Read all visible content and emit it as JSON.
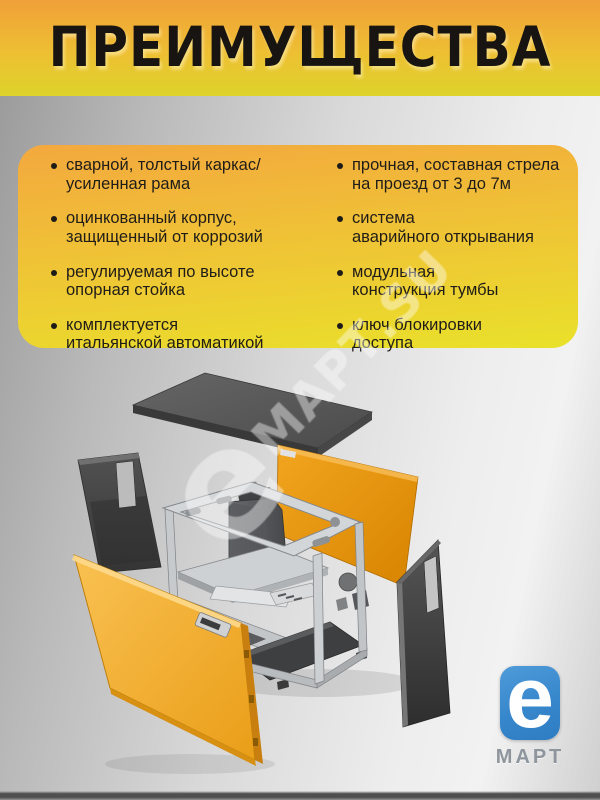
{
  "header": {
    "title": "ПРЕИМУЩЕСТВА"
  },
  "card": {
    "left": [
      "сварной, толстый каркас/\nусиленная рама",
      "оцинкованный корпус,\nзащищенный от коррозий",
      "регулируемая по высоте\nопорная стойка",
      "комплектуется\nитальянской автоматикой"
    ],
    "right": [
      "прочная, составная стрела\nна проезд от 3 до 7м",
      "система\nаварийного открывания",
      "модульная\nконструкция тумбы",
      "ключ блокировки\nдоступа"
    ]
  },
  "watermark": {
    "e": "e",
    "text": "МАРТ.SU"
  },
  "logo": {
    "letter": "e",
    "brand": "МАРТ"
  },
  "diagram": {
    "type": "exploded-view",
    "parts": [
      "top-cover",
      "left-rear-panel",
      "rear-orange-panel",
      "cabinet-frame",
      "motor-unit",
      "base-plate",
      "right-side-panel",
      "front-yellow-panel"
    ]
  },
  "colors": {
    "header_top": "#f0a038",
    "header_bottom": "#ddd32b",
    "card_top": "#f3a83e",
    "card_bottom": "#e9e12a",
    "panel_orange": "#e08d0e",
    "panel_yellow": "#f2ac2e",
    "logo_blue": "#3787cc",
    "background_gray": "#d9d9d9"
  }
}
